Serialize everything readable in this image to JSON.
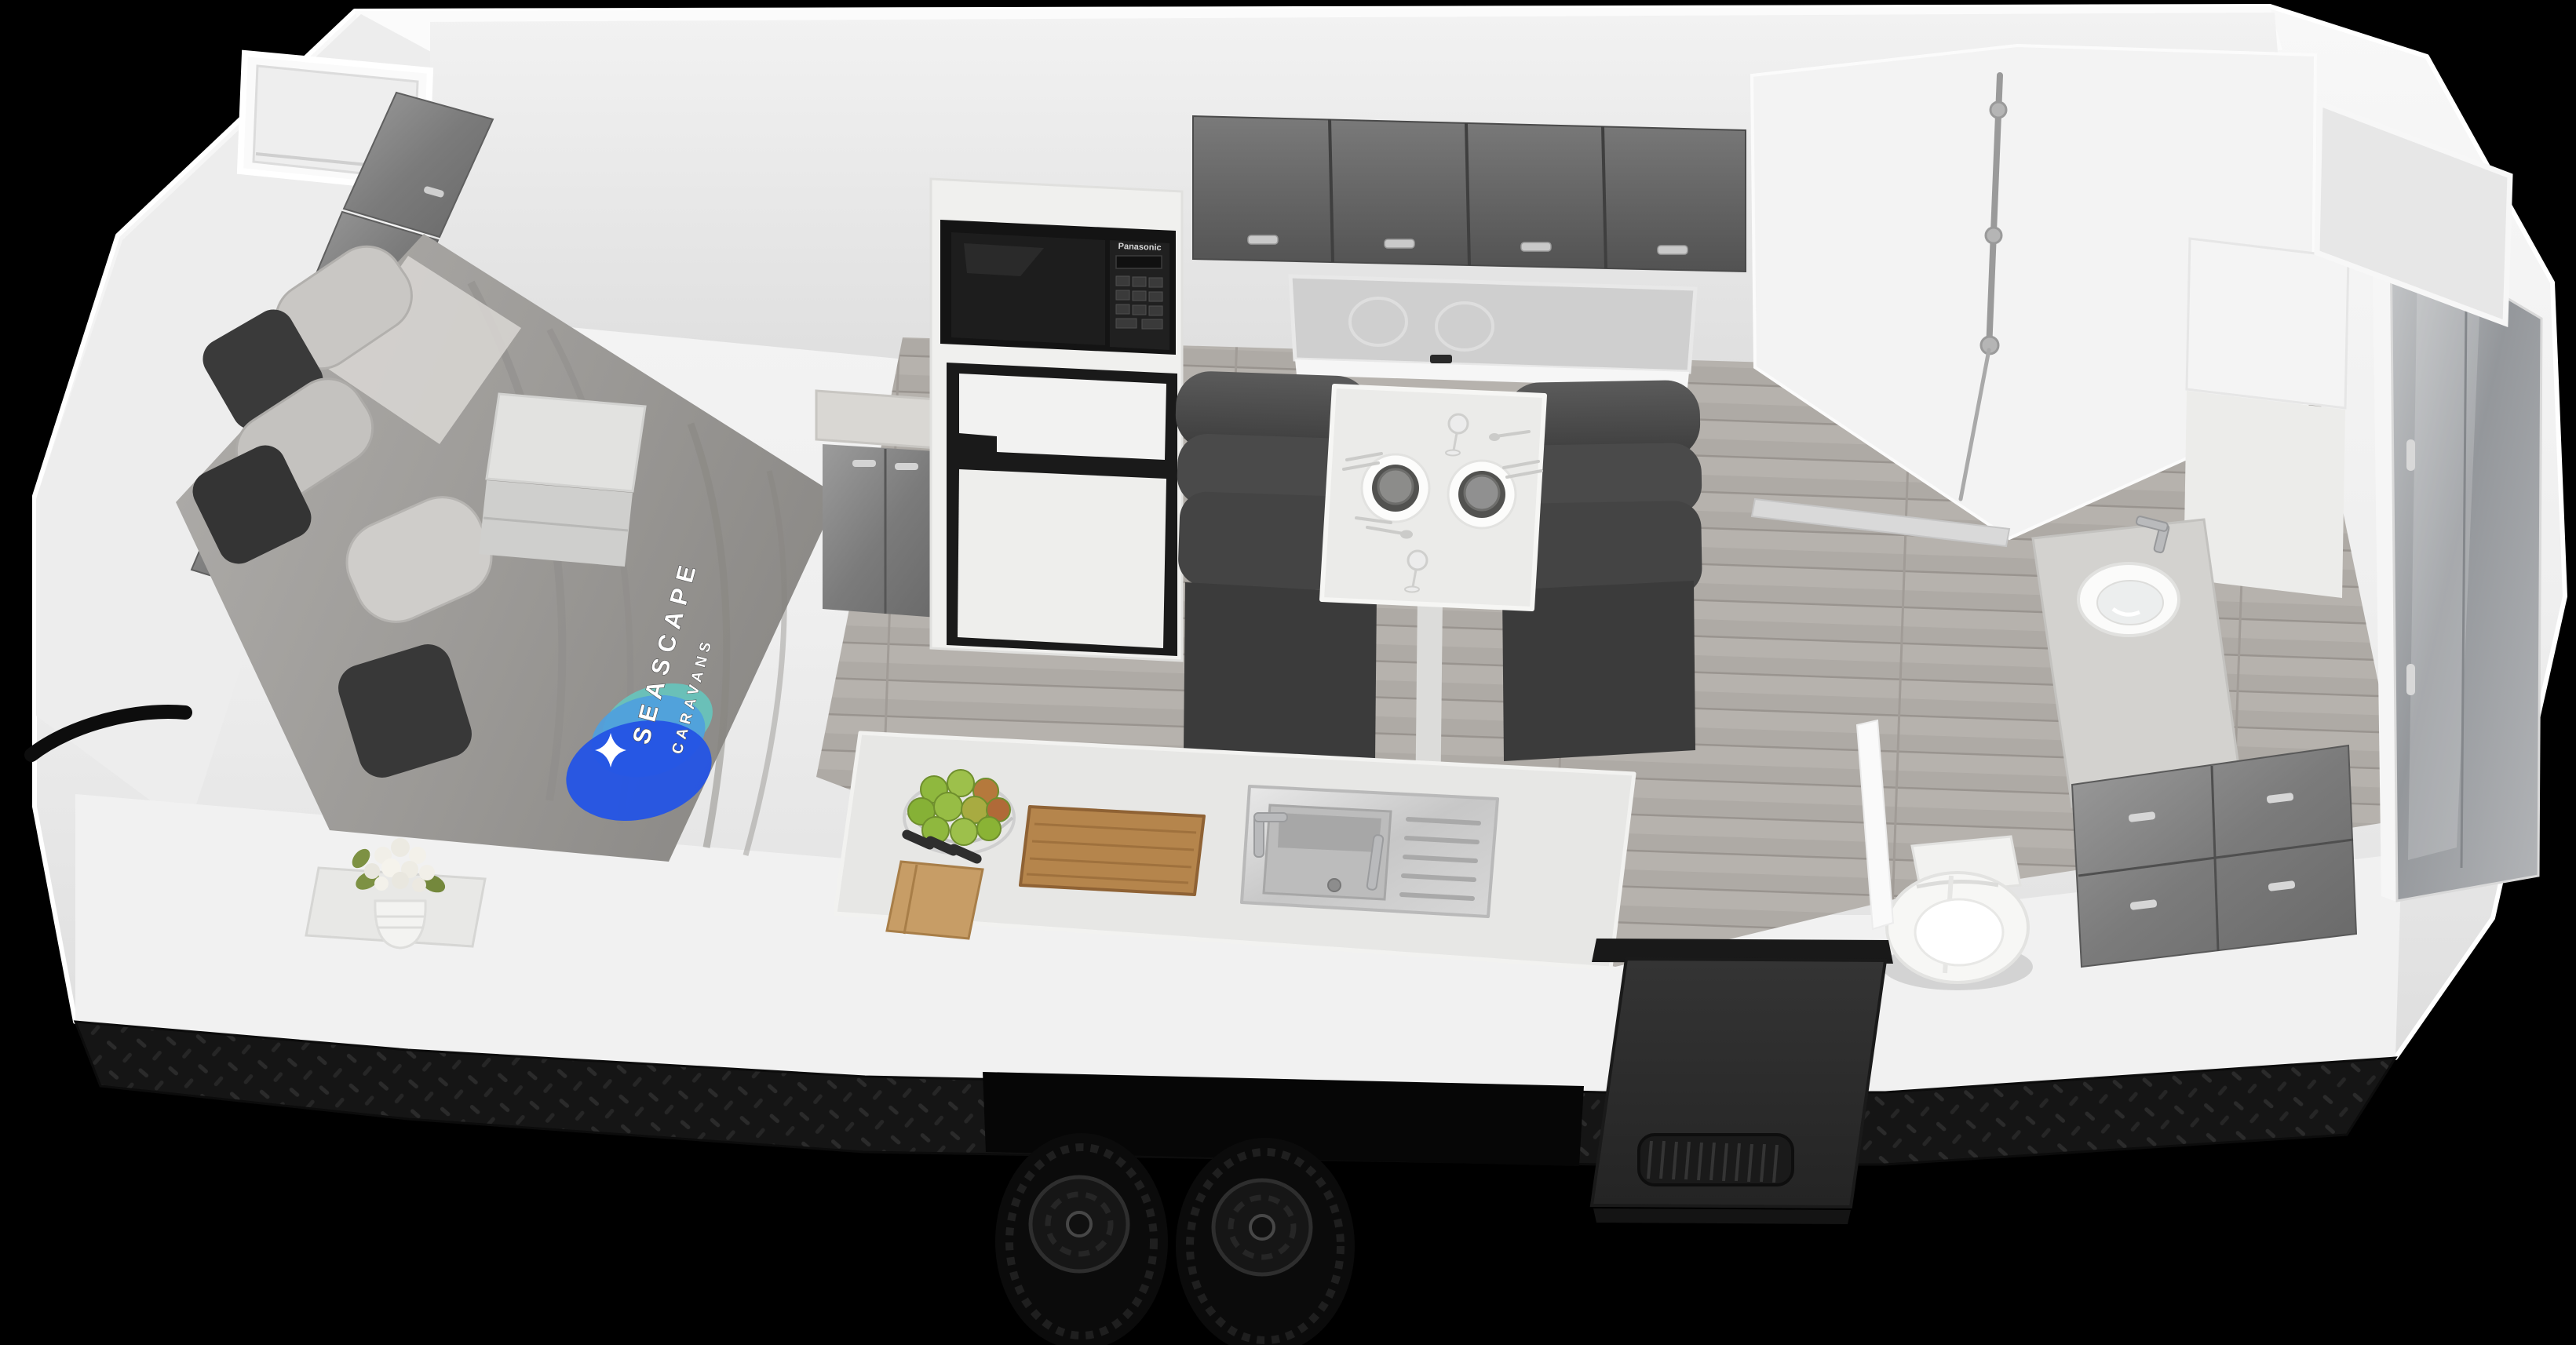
{
  "scene": {
    "type": "3d-cutaway-render",
    "subject": "Seascape Caravans tandem-axle caravan interior layout",
    "view": "elevated front-right isometric cutaway",
    "background_color": "#000000"
  },
  "branding": {
    "logo_line1": "SEASCAPE",
    "logo_line2": "CARAVANS",
    "logo_teal": "#68c3ba",
    "logo_light_blue": "#4f9fdd",
    "logo_dark_blue": "#2454e4",
    "logo_sparkle": "#ffffff"
  },
  "appliances": {
    "microwave_brand": "Panasonic"
  },
  "zones": {
    "bedroom": {
      "items": [
        "bed with grey quilt and branded throw",
        "grey pillows",
        "charcoal cushions",
        "front window with blind",
        "gloss-grey wardrobe cabinets",
        "bedside table",
        "vase of white tulips"
      ]
    },
    "kitchen": {
      "items": [
        "Panasonic microwave",
        "fridge-freezer with white doors",
        "gloss-grey overhead cupboards",
        "splashback window with burner reflections",
        "bench with stainless sink and drainer",
        "mixer tap",
        "timber chopping board",
        "wire basket of green apples",
        "timber knife block"
      ]
    },
    "dinette": {
      "items": [
        "two charcoal cafe lounges",
        "white pedestal table",
        "two place settings with plates and bowls",
        "two stem glasses",
        "cutlery"
      ]
    },
    "bathroom": {
      "items": [
        "shower with chrome rail and hose",
        "round basin vanity with mixer tap",
        "gloss-grey drawer bank",
        "toilet",
        "tall linen cupboard",
        "mirrored rear wardrobe",
        "rear window"
      ]
    },
    "exterior": {
      "items": [
        "white body shell",
        "black checker-plate skirt",
        "tandem black alloy wheels",
        "black entry door with vent grille",
        "front grab handle"
      ]
    }
  },
  "palette": {
    "body_white": "#f4f4f4",
    "cabinet_grey": "#7d7d7d",
    "upholstery_charcoal": "#4a4a4a",
    "floor_grey_timber": "#b4b0ab",
    "timber": "#b5854c",
    "apple_green": "#8fb83e",
    "checker_black": "#161616"
  }
}
